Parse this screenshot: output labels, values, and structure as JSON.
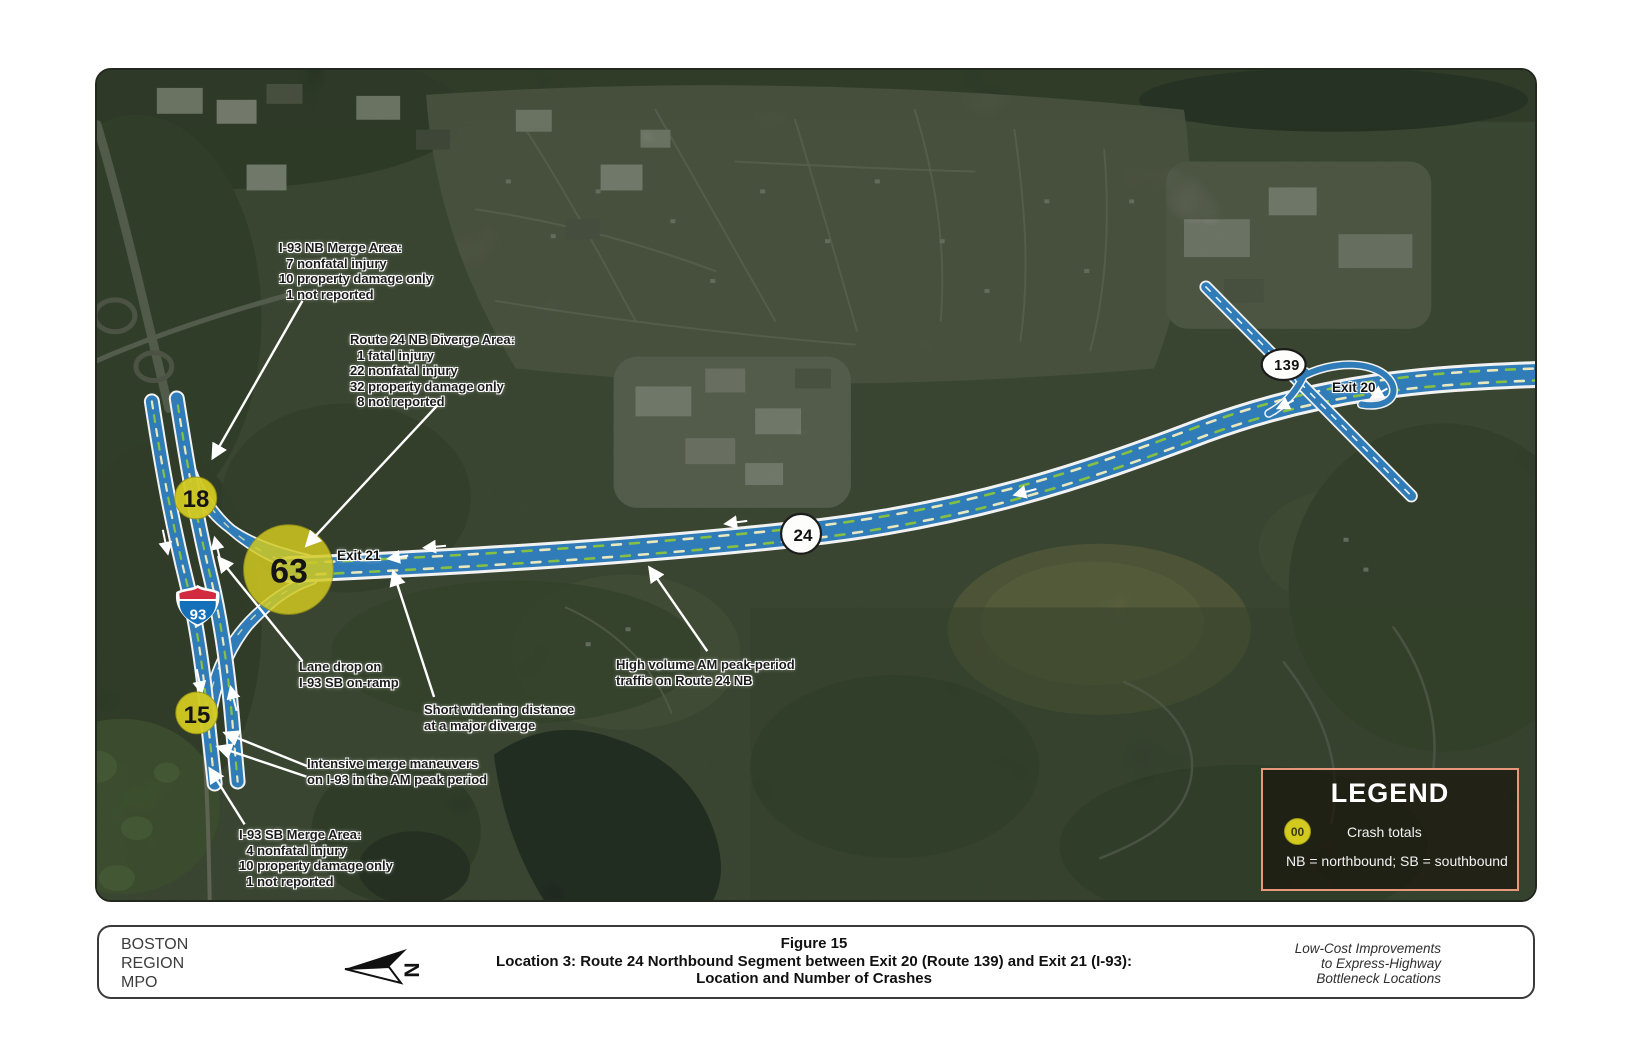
{
  "map": {
    "shields": {
      "i93": "93",
      "r24": "24",
      "r139": "139"
    },
    "exit_labels": {
      "exit21": "Exit 21",
      "exit20": "Exit 20"
    },
    "crash_circles": [
      {
        "area": "I-93 NB merge area",
        "total": "18"
      },
      {
        "area": "Route 24 NB diverge area",
        "total": "63"
      },
      {
        "area": "I-93 SB merge area",
        "total": "15"
      }
    ],
    "annotations": {
      "i93_nb_merge": "I-93 NB Merge Area:\n  7 nonfatal injury\n10 property damage only\n  1 not reported",
      "route24_diverge": "Route 24 NB Diverge Area:\n  1 fatal injury\n22 nonfatal injury\n32 property damage only\n  8 not reported",
      "lane_drop": "Lane drop on\nI-93 SB on-ramp",
      "short_widening": "Short widening distance\nat a major diverge",
      "intensive_merge": "Intensive merge maneuvers\non I-93 in the AM peak period",
      "i93_sb_merge": "I-93 SB Merge Area:\n  4 nonfatal injury\n10 property damage only\n  1 not reported",
      "high_volume": "High volume AM peak-period\ntraffic on Route 24 NB"
    }
  },
  "legend": {
    "title": "LEGEND",
    "symbol_label": "00",
    "symbol_meaning": "Crash totals",
    "note": "NB = northbound; SB = southbound",
    "border_color": "#e8987a"
  },
  "caption": {
    "agency": "BOSTON\nREGION\nMPO",
    "north_label": "N",
    "figure_number": "Figure 15",
    "title": "Location 3: Route 24 Northbound Segment between Exit 20 (Route 139) and Exit 21 (I-93):",
    "subtitle": "Location and Number of Crashes",
    "project": "Low-Cost Improvements\nto Express-Highway\nBottleneck Locations"
  },
  "colors": {
    "highway_blue": "#2f7cb8",
    "crash_yellow": "#d3ca20",
    "interstate_red": "#d22a3f",
    "interstate_blue": "#1470b8",
    "legend_border": "#e8987a"
  }
}
